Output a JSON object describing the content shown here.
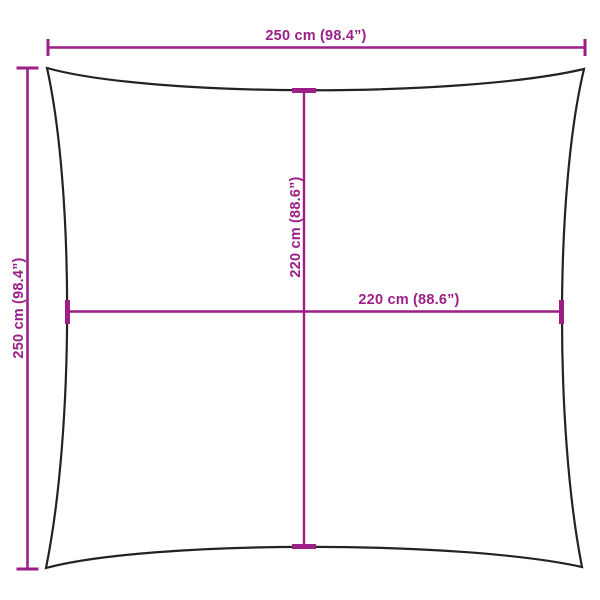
{
  "diagram": {
    "description": "Square shade sail dimension drawing",
    "colors": {
      "dimension_line": "#9B1F87",
      "outline": "#232323",
      "background": "#FFFFFF"
    },
    "measurements": {
      "outer_width": "250 cm (98.4”)",
      "outer_height": "250 cm (98.4”)",
      "inner_height": "220 cm (88.6”)",
      "inner_width": "220 cm (88.6”)"
    }
  }
}
